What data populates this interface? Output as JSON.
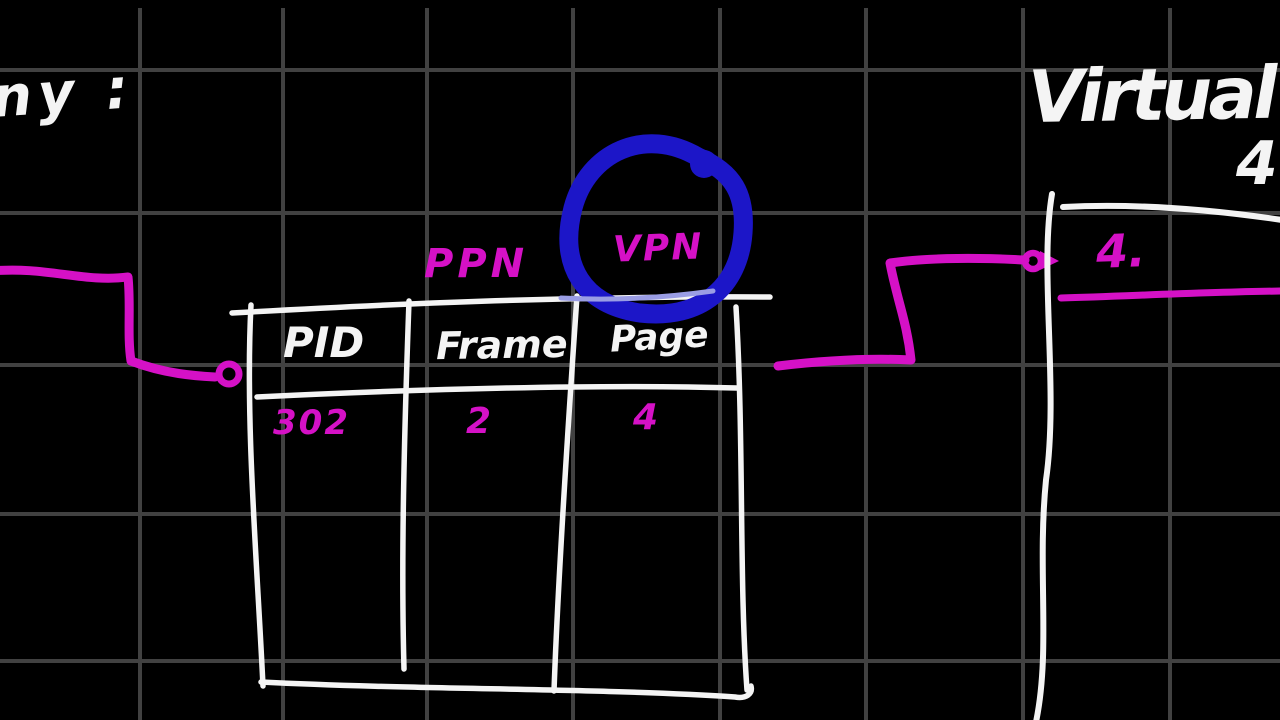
{
  "colors": {
    "background": "#000000",
    "grid": "#414141",
    "ink_white": "#f4f4f4",
    "ink_magenta": "#d511c6",
    "highlight_blue": "#1c16c8"
  },
  "annotations": {
    "top_left_fragment": "ny :",
    "virtual_memory_title_fragment": "Virtual m",
    "virtual_memory_number_fragment": "4",
    "ppn_label": "PPN",
    "vpn_label": "VPN"
  },
  "page_table": {
    "headers": [
      "PID",
      "Frame",
      "Page"
    ],
    "rows": [
      [
        "302",
        "2",
        "4"
      ]
    ]
  },
  "right_panel": {
    "entry_label": "4."
  }
}
